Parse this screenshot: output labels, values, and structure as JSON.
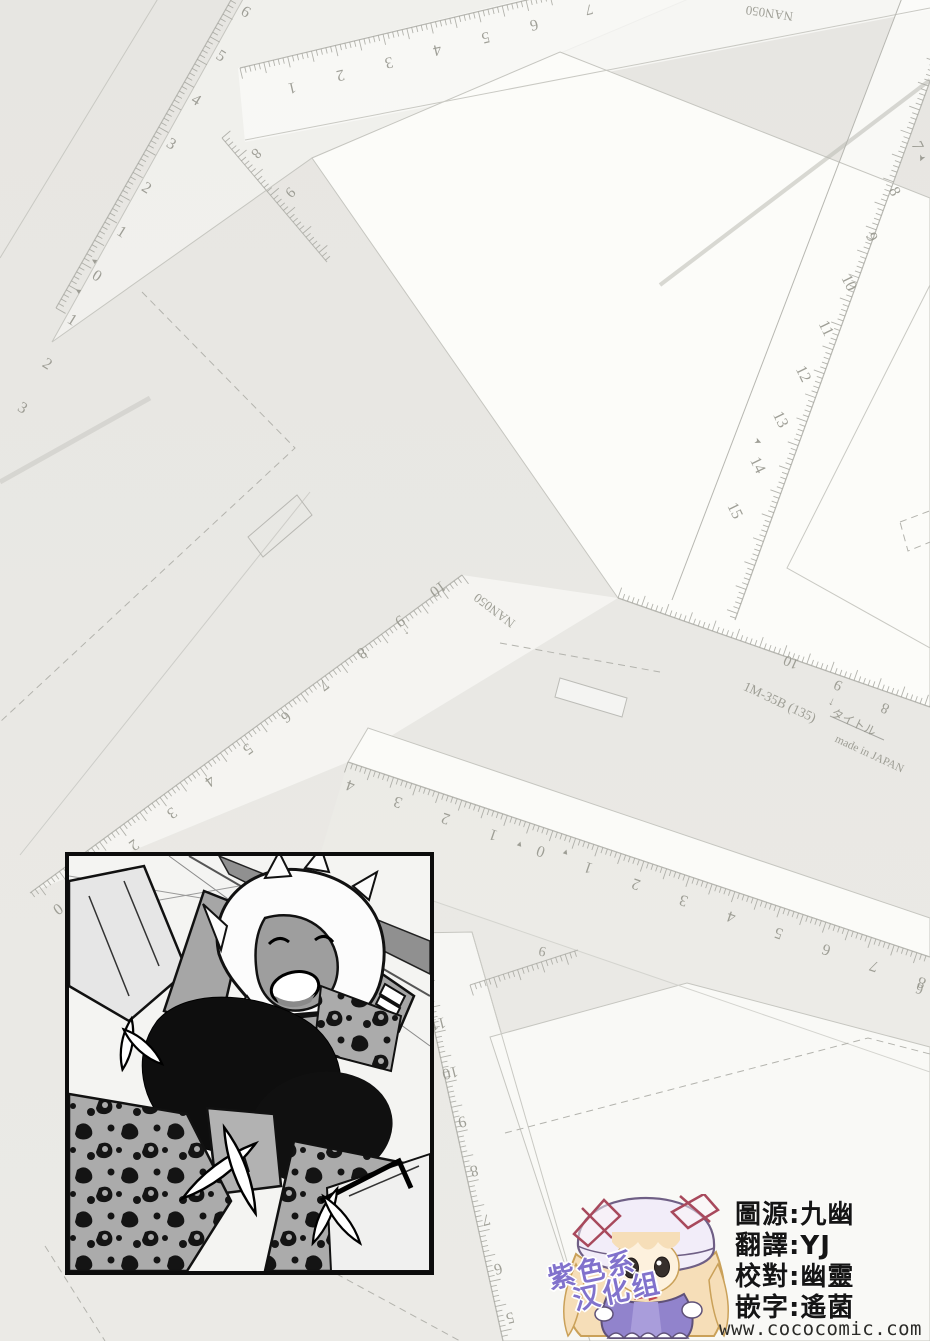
{
  "page": {
    "width": 930,
    "height": 1341,
    "bg_color": "#e9e8e4",
    "kind": "scanlation credits page over scanned drafting rulers"
  },
  "credits": {
    "lines": [
      "圖源:九幽",
      "翻譯:YJ",
      "校對:幽靈",
      "嵌字:遙菌"
    ],
    "site": "www.cococomic.com",
    "text_color": "#151515"
  },
  "logo": {
    "line1": "紫色系",
    "line2": "汉化组",
    "color": "#8172cc"
  },
  "mascot": {
    "name": "chibi-girl-with-mob-cap",
    "hat_color": "#f2edf9",
    "ribbon_color": "#a8495c",
    "hair_color": "#f6deb8",
    "skin_color": "#fdf1dd",
    "dress_color": "#9183cc",
    "eye_color": "#362f2c"
  },
  "scan": {
    "rulers": [
      {
        "id": "topleft-scale",
        "labels": [
          "3",
          "2",
          "1",
          "0",
          "1",
          "2",
          "3",
          "4",
          "5",
          "6"
        ],
        "x0": 20,
        "y0": 412,
        "dx": 24.8,
        "dy": -44,
        "rot": 32,
        "size": 16,
        "edge": [
          56,
          308,
          248,
          -30
        ],
        "side": 1,
        "step": 5.2
      },
      {
        "id": "top-ruler",
        "labels": [
          "1",
          "2",
          "3",
          "4",
          "5",
          "6"
        ],
        "x0": 291,
        "y0": 83,
        "dx": 48.4,
        "dy": -12.6,
        "rot": 167,
        "size": 16,
        "edge": [
          240,
          68,
          700,
          -41
        ],
        "side": 1,
        "step": 4.9
      },
      {
        "id": "small-scale-e",
        "labels": [
          "8",
          "9"
        ],
        "x0": 253,
        "y0": 150,
        "dx": 34,
        "dy": 39,
        "rot": 135,
        "size": 15,
        "edge": [
          222,
          138,
          327,
          262
        ],
        "side": -1,
        "step": 5
      },
      {
        "id": "right-ruler",
        "labels": [
          "7",
          "8",
          "9",
          "10",
          "11",
          "12",
          "13",
          "14",
          "15"
        ],
        "x0": 913,
        "y0": 148,
        "dx": -22.8,
        "dy": 45.6,
        "rot": 64,
        "size": 16,
        "edge": [
          963,
          -10,
          735,
          620
        ],
        "side": 1,
        "step": 5.1
      },
      {
        "id": "template-1m35b-scale",
        "labels": [
          "10",
          "9",
          "8"
        ],
        "x0": 793,
        "y0": 658,
        "dx": 47,
        "dy": 23,
        "rot": 204,
        "size": 15,
        "edge": [
          618,
          598,
          930,
          707
        ],
        "side": -1,
        "step": 5
      },
      {
        "id": "center-zero-ruler",
        "labels": [
          "4",
          "3",
          "2",
          "1",
          "0",
          "1",
          "2",
          "3",
          "4",
          "5",
          "6",
          "7",
          "8"
        ],
        "x0": 352,
        "y0": 781,
        "dx": 47.6,
        "dy": 16.4,
        "rot": 199,
        "size": 16,
        "edge": [
          348,
          762,
          930,
          957
        ],
        "side": 1,
        "step": 4.8
      },
      {
        "id": "mid-left-scale",
        "labels": [
          "10",
          "9",
          "8",
          "7",
          "6",
          "5",
          "4",
          "3",
          "2",
          "1",
          "0"
        ],
        "x0": 435,
        "y0": 585,
        "dx": -38,
        "dy": 32,
        "rot": 144,
        "size": 16,
        "edge": [
          462,
          575,
          30,
          893
        ],
        "side": -1,
        "step": 5
      },
      {
        "id": "bottom-vertical-ruler",
        "labels": [
          "12",
          "11",
          "10",
          "9",
          "8",
          "7",
          "6",
          "5"
        ],
        "x0": 425,
        "y0": 970,
        "dx": 12,
        "dy": 49,
        "rot": 166,
        "size": 16,
        "edge": [
          413,
          933,
          503,
          1341
        ],
        "side": -1,
        "step": 5.1
      },
      {
        "id": "bottom-small-scale",
        "labels": [
          "9"
        ],
        "x0": 543,
        "y0": 947,
        "dx": 30,
        "dy": -10,
        "rot": 190,
        "size": 14,
        "edge": [
          470,
          985,
          578,
          950
        ],
        "side": 1,
        "step": 5
      }
    ],
    "texts": [
      {
        "t": "NAN050",
        "x": 770,
        "y": 9,
        "rot": 188,
        "size": 13
      },
      {
        "t": "NAN050",
        "x": 497,
        "y": 607,
        "rot": 217,
        "size": 13
      },
      {
        "t": "1M-35B (135)",
        "x": 778,
        "y": 706,
        "rot": 25,
        "size": 13.5
      },
      {
        "t": "タイトル",
        "x": 852,
        "y": 726,
        "rot": 25,
        "size": 12
      },
      {
        "t": "made in JAPAN",
        "x": 868,
        "y": 757,
        "rot": 25,
        "size": 11.5
      },
      {
        "t": "↑",
        "x": 833,
        "y": 699,
        "rot": 205,
        "size": 12
      },
      {
        "t": "↑",
        "x": 404,
        "y": 629,
        "rot": 144,
        "size": 11
      },
      {
        "t": "➤",
        "x": 919,
        "y": 157,
        "rot": 115,
        "size": 9
      },
      {
        "t": "➤",
        "x": 757,
        "y": 444,
        "rot": 24,
        "size": 9
      },
      {
        "t": "▲",
        "x": 519,
        "y": 846,
        "rot": 19,
        "size": 8
      },
      {
        "t": "▲",
        "x": 565,
        "y": 854,
        "rot": 19,
        "size": 8
      },
      {
        "t": "▲",
        "x": 96,
        "y": 262,
        "rot": -58,
        "size": 8
      },
      {
        "t": "▲",
        "x": 80,
        "y": 292,
        "rot": -58,
        "size": 8
      },
      {
        "t": "7",
        "x": 588,
        "y": 5,
        "rot": 167,
        "size": 15
      },
      {
        "t": "6",
        "x": 921,
        "y": 985,
        "rot": 199,
        "size": 14
      }
    ]
  }
}
